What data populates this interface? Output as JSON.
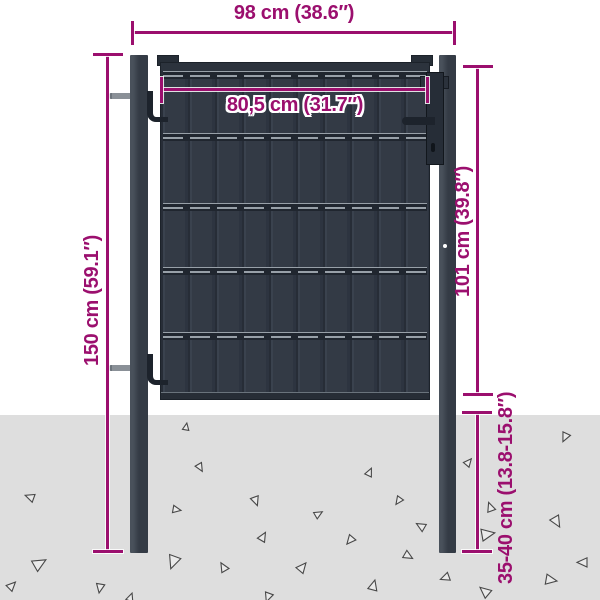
{
  "title": "Fence gate dimension diagram",
  "dimensions": {
    "overall_width": "98 cm (38.6″)",
    "gate_width": "80,5 cm (31.7″)",
    "post_height": "150 cm (59.1″)",
    "gate_height": "101 cm (39.8″)",
    "ground_depth": "35-40 cm (13.8-15.8″)"
  },
  "colors": {
    "dimension": "#9b0f6e",
    "gate": "#333a45",
    "post": "#343b45",
    "ground": "#dedede"
  },
  "scene": {
    "triangles": [
      {
        "x": 183,
        "y": 423,
        "s": 7,
        "r": 10
      },
      {
        "x": 560,
        "y": 433,
        "s": 9,
        "r": 205
      },
      {
        "x": 196,
        "y": 464,
        "s": 8,
        "r": 150
      },
      {
        "x": 366,
        "y": 468,
        "s": 8,
        "r": 25
      },
      {
        "x": 465,
        "y": 458,
        "s": 8,
        "r": 40
      },
      {
        "x": 25,
        "y": 492,
        "s": 9,
        "r": 290
      },
      {
        "x": 251,
        "y": 497,
        "s": 9,
        "r": 160
      },
      {
        "x": 394,
        "y": 497,
        "s": 8,
        "r": 215
      },
      {
        "x": 486,
        "y": 502,
        "s": 9,
        "r": 340
      },
      {
        "x": 315,
        "y": 510,
        "s": 8,
        "r": 60
      },
      {
        "x": 173,
        "y": 506,
        "s": 8,
        "r": 100
      },
      {
        "x": 416,
        "y": 521,
        "s": 9,
        "r": 300
      },
      {
        "x": 551,
        "y": 517,
        "s": 11,
        "r": 150
      },
      {
        "x": 259,
        "y": 532,
        "s": 9,
        "r": 30
      },
      {
        "x": 345,
        "y": 536,
        "s": 9,
        "r": 220
      },
      {
        "x": 482,
        "y": 528,
        "s": 13,
        "r": 80
      },
      {
        "x": 404,
        "y": 552,
        "s": 9,
        "r": 120
      },
      {
        "x": 166,
        "y": 556,
        "s": 13,
        "r": 200
      },
      {
        "x": 219,
        "y": 562,
        "s": 9,
        "r": 330
      },
      {
        "x": 298,
        "y": 562,
        "s": 10,
        "r": 40
      },
      {
        "x": 34,
        "y": 557,
        "s": 13,
        "r": 60
      },
      {
        "x": 440,
        "y": 573,
        "s": 9,
        "r": 250
      },
      {
        "x": 369,
        "y": 580,
        "s": 10,
        "r": 15
      },
      {
        "x": 95,
        "y": 584,
        "s": 9,
        "r": 190
      },
      {
        "x": 479,
        "y": 585,
        "s": 11,
        "r": 310
      },
      {
        "x": 546,
        "y": 575,
        "s": 11,
        "r": 100
      },
      {
        "x": 8,
        "y": 581,
        "s": 9,
        "r": 45
      },
      {
        "x": 577,
        "y": 557,
        "s": 10,
        "r": 270
      },
      {
        "x": 127,
        "y": 593,
        "s": 8,
        "r": 20
      },
      {
        "x": 263,
        "y": 593,
        "s": 9,
        "r": 200
      }
    ]
  }
}
